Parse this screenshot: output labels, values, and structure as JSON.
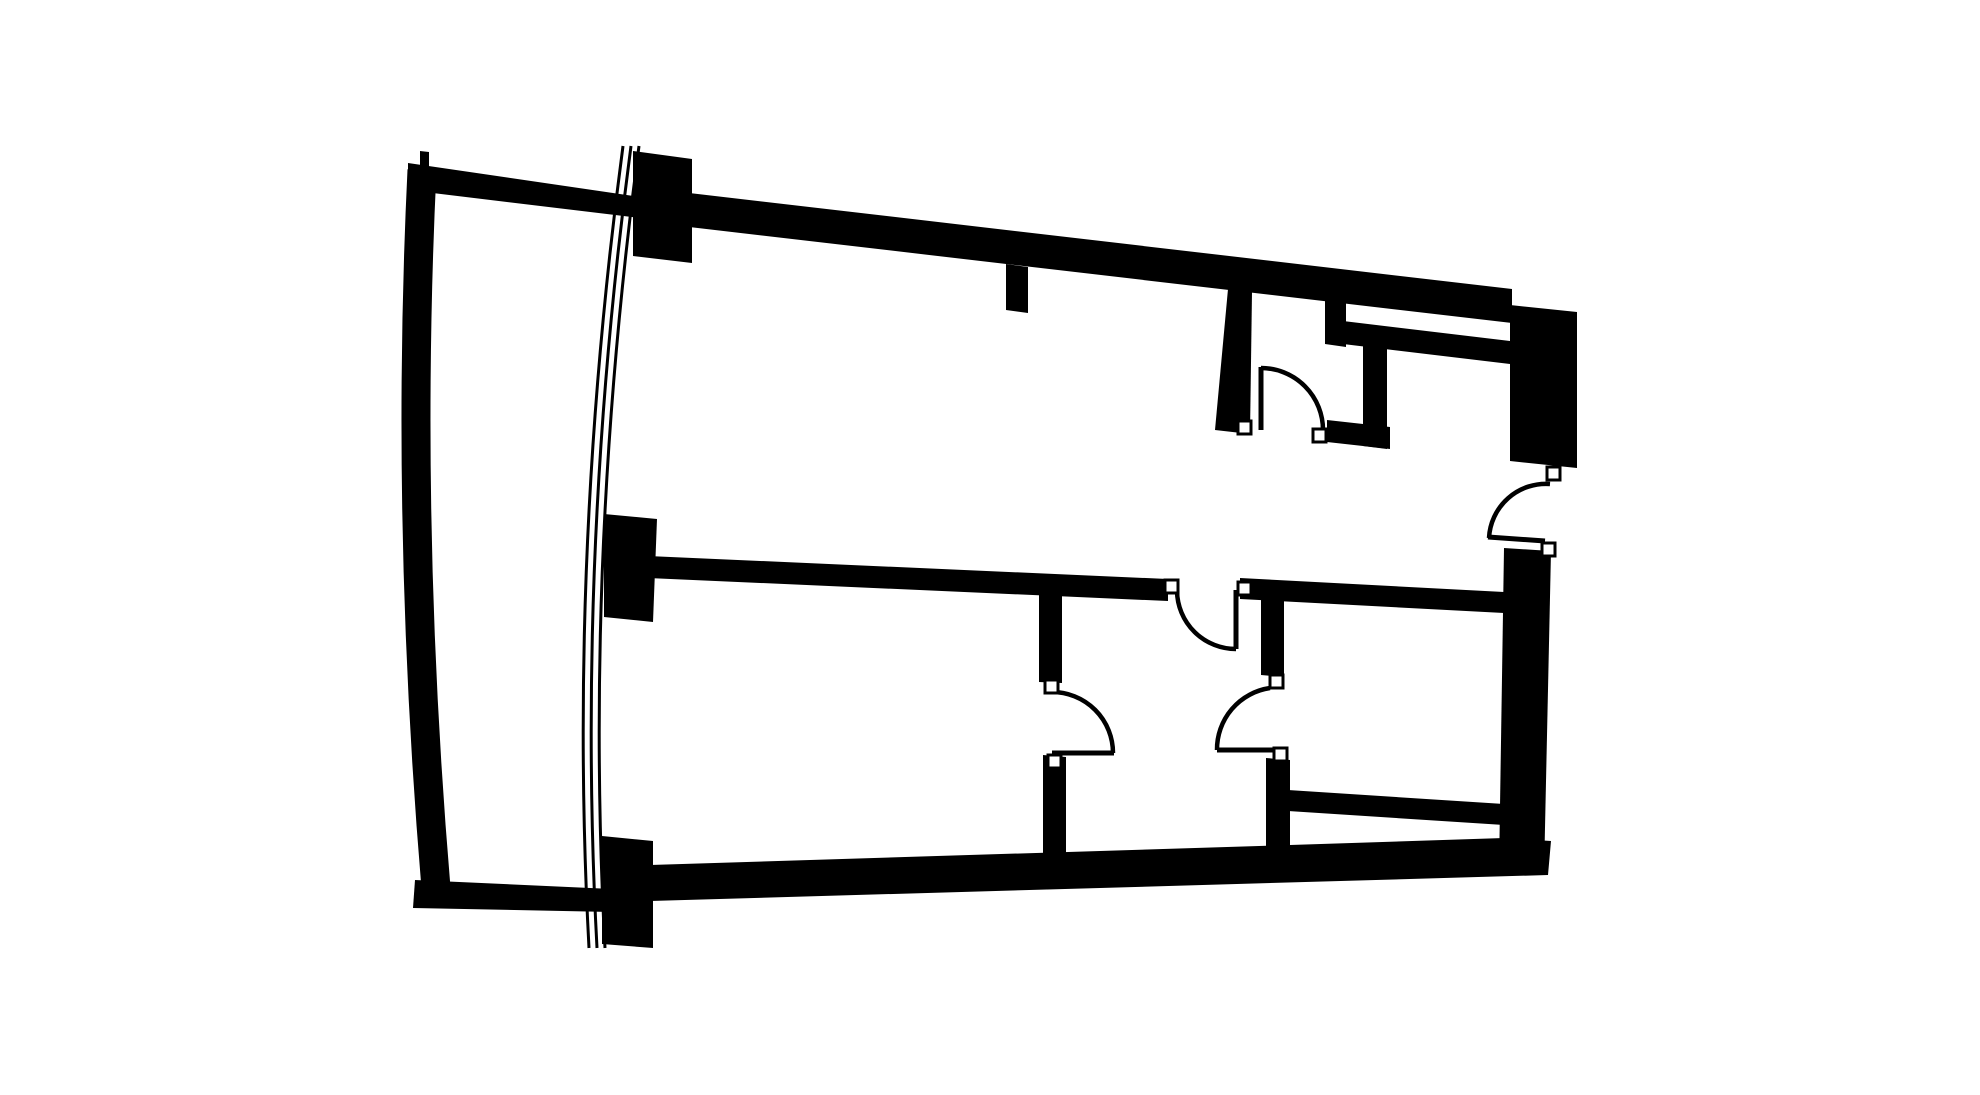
{
  "canvas": {
    "width": 1980,
    "height": 1095,
    "background": "#ffffff",
    "ink": "#000000"
  },
  "floorplan": {
    "description": "apartment-floor-plan",
    "wall_fill": "#000000",
    "stroke": {
      "leaf_width": 5,
      "arc_width": 4.5,
      "jamb_stroke": 3,
      "jamb_fill": "#ffffff"
    },
    "walls": [
      {
        "name": "terrace-north-wall",
        "points": [
          [
            408,
            163
          ],
          [
            640,
            197
          ],
          [
            640,
            218
          ],
          [
            408,
            190
          ]
        ]
      },
      {
        "name": "corner-tick",
        "points": [
          [
            420,
            151
          ],
          [
            429,
            152
          ],
          [
            429,
            169
          ],
          [
            420,
            168
          ]
        ]
      },
      {
        "name": "facade-column-top",
        "points": [
          [
            633,
            151
          ],
          [
            692,
            159
          ],
          [
            692,
            263
          ],
          [
            633,
            256
          ]
        ]
      },
      {
        "name": "facade-column-middle",
        "points": [
          [
            604,
            514
          ],
          [
            657,
            519
          ],
          [
            653,
            622
          ],
          [
            604,
            617
          ]
        ]
      },
      {
        "name": "facade-column-bottom",
        "points": [
          [
            602,
            836
          ],
          [
            653,
            841
          ],
          [
            653,
            948
          ],
          [
            602,
            944
          ]
        ]
      },
      {
        "name": "top-exterior-wall",
        "points": [
          [
            655,
            189
          ],
          [
            1512,
            289
          ],
          [
            1512,
            323
          ],
          [
            655,
            223
          ]
        ]
      },
      {
        "name": "top-right-corner-block",
        "points": [
          [
            1510,
            305
          ],
          [
            1577,
            312
          ],
          [
            1577,
            468
          ],
          [
            1510,
            461
          ]
        ]
      },
      {
        "name": "top-wall-stub",
        "points": [
          [
            1006,
            264
          ],
          [
            1028,
            267
          ],
          [
            1028,
            313
          ],
          [
            1006,
            310
          ]
        ]
      },
      {
        "name": "wc-west-wall",
        "points": [
          [
            1228,
            289
          ],
          [
            1252,
            292
          ],
          [
            1250,
            434
          ],
          [
            1215,
            430
          ]
        ]
      },
      {
        "name": "wc-slot-left-stub",
        "points": [
          [
            1325,
            299
          ],
          [
            1346,
            302
          ],
          [
            1346,
            347
          ],
          [
            1325,
            344
          ]
        ]
      },
      {
        "name": "wc-slot-bar",
        "points": [
          [
            1343,
            321
          ],
          [
            1510,
            341
          ],
          [
            1510,
            364
          ],
          [
            1343,
            344
          ]
        ]
      },
      {
        "name": "wc-east-wall",
        "points": [
          [
            1363,
            343
          ],
          [
            1387,
            346
          ],
          [
            1387,
            449
          ],
          [
            1363,
            446
          ]
        ]
      },
      {
        "name": "wc-south-wall",
        "points": [
          [
            1327,
            420
          ],
          [
            1390,
            427
          ],
          [
            1390,
            449
          ],
          [
            1327,
            442
          ]
        ]
      },
      {
        "name": "middle-wall",
        "points": [
          [
            648,
            556
          ],
          [
            1168,
            579
          ],
          [
            1168,
            601
          ],
          [
            648,
            578
          ]
        ]
      },
      {
        "name": "hall-north-wall",
        "points": [
          [
            1240,
            578
          ],
          [
            1504,
            592
          ],
          [
            1504,
            613
          ],
          [
            1240,
            599
          ]
        ]
      },
      {
        "name": "hall-east-wall-upper",
        "points": [
          [
            1261,
            596
          ],
          [
            1284,
            598
          ],
          [
            1284,
            677
          ],
          [
            1261,
            675
          ]
        ]
      },
      {
        "name": "hall-east-wall-lower",
        "points": [
          [
            1266,
            758
          ],
          [
            1290,
            760
          ],
          [
            1290,
            852
          ],
          [
            1266,
            849
          ]
        ]
      },
      {
        "name": "hall-west-wall-upper",
        "points": [
          [
            1039,
            593
          ],
          [
            1062,
            594
          ],
          [
            1062,
            683
          ],
          [
            1039,
            682
          ]
        ]
      },
      {
        "name": "hall-west-wall-lower",
        "points": [
          [
            1043,
            755
          ],
          [
            1066,
            757
          ],
          [
            1066,
            864
          ],
          [
            1043,
            861
          ]
        ]
      },
      {
        "name": "room2-south-wall",
        "points": [
          [
            1288,
            790
          ],
          [
            1504,
            804
          ],
          [
            1504,
            825
          ],
          [
            1288,
            811
          ]
        ]
      },
      {
        "name": "bottom-interior-wall",
        "points": [
          [
            650,
            865
          ],
          [
            1290,
            845
          ],
          [
            1504,
            838
          ],
          [
            1551,
            841
          ],
          [
            1548,
            875
          ],
          [
            650,
            901
          ]
        ]
      },
      {
        "name": "bottom-exterior-wall",
        "points": [
          [
            415,
            880
          ],
          [
            612,
            889
          ],
          [
            612,
            912
          ],
          [
            413,
            908
          ]
        ]
      },
      {
        "name": "right-exterior-wall",
        "points": [
          [
            1504,
            548
          ],
          [
            1551,
            551
          ],
          [
            1544,
            874
          ],
          [
            1499,
            871
          ]
        ]
      }
    ],
    "curved_wall": {
      "name": "terrace-west-wall",
      "d": "M 422 170 Q 405 520 436 888",
      "stroke_width": 29
    },
    "glazing": {
      "name": "curtain-wall-glazing-line",
      "stroke_width": 3,
      "lines": [
        "M 623 146 Q 568 560 589 948",
        "M 631 146 Q 576 560 597 948",
        "M 639 146 Q 584 560 605 948"
      ]
    },
    "doors": [
      {
        "name": "wc-door",
        "leaf": [
          1261,
          430,
          1261,
          367
        ],
        "arc": "M 1261 368 A 62 62 0 0 1 1323 430"
      },
      {
        "name": "entry-door",
        "leaf": [
          1545,
          541,
          1488,
          537
        ],
        "arc": "M 1550 484 A 57 57 0 0 0 1489 538"
      },
      {
        "name": "hall-north-door",
        "leaf": [
          1236,
          590,
          1236,
          649
        ],
        "arc": "M 1177 591 A 59 59 0 0 0 1236 649"
      },
      {
        "name": "hall-west-door",
        "leaf": [
          1052,
          753,
          1114,
          753
        ],
        "arc": "M 1052 692 A 61 61 0 0 1 1113 753"
      },
      {
        "name": "hall-east-door",
        "leaf": [
          1278,
          750,
          1217,
          750
        ],
        "arc": "M 1270 688 A 62 62 0 0 0 1217 750"
      }
    ],
    "jambs": [
      {
        "name": "wc-door-left",
        "x": 1238,
        "y": 421,
        "size": 13
      },
      {
        "name": "wc-door-right",
        "x": 1313,
        "y": 429,
        "size": 13
      },
      {
        "name": "middle-wall-end",
        "x": 1165,
        "y": 580,
        "size": 13
      },
      {
        "name": "hall-north-door-hinge",
        "x": 1238,
        "y": 582,
        "size": 13
      },
      {
        "name": "hall-west-door-upper",
        "x": 1045,
        "y": 680,
        "size": 13
      },
      {
        "name": "hall-west-door-lower",
        "x": 1048,
        "y": 755,
        "size": 13
      },
      {
        "name": "hall-east-door-upper",
        "x": 1270,
        "y": 675,
        "size": 13
      },
      {
        "name": "hall-east-door-lower",
        "x": 1274,
        "y": 748,
        "size": 13
      },
      {
        "name": "entry-door-upper",
        "x": 1547,
        "y": 467,
        "size": 13
      },
      {
        "name": "entry-door-lower",
        "x": 1542,
        "y": 543,
        "size": 13
      }
    ]
  }
}
